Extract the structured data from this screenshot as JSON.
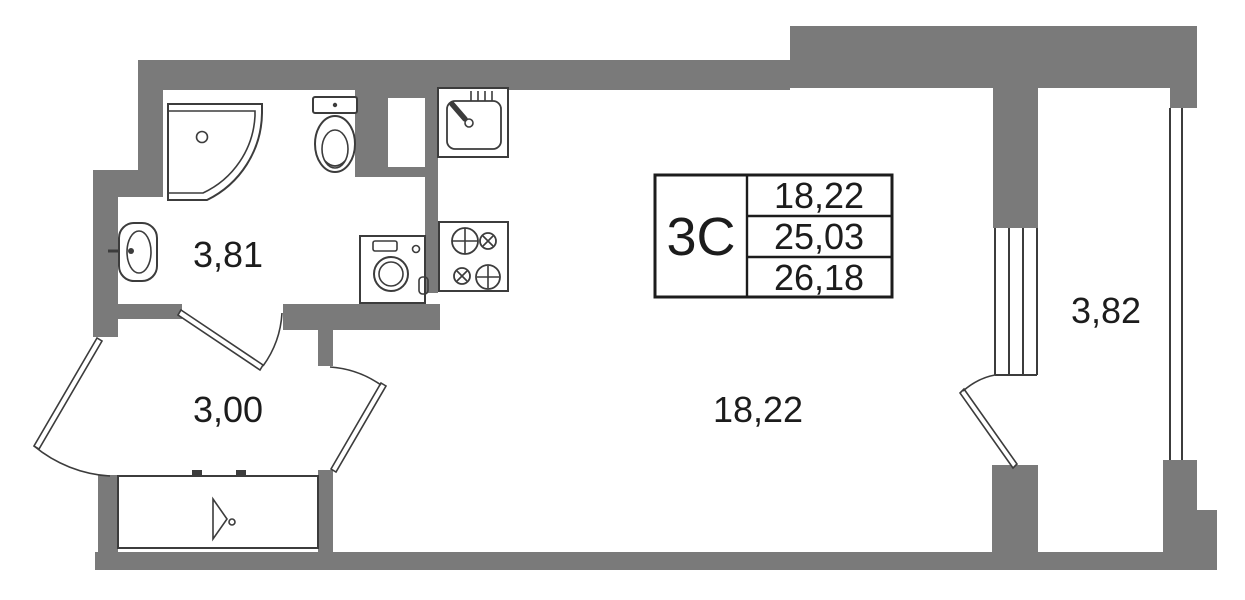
{
  "plan": {
    "rooms": [
      {
        "id": "bathroom",
        "area": "3,81"
      },
      {
        "id": "hallway",
        "area": "3,00"
      },
      {
        "id": "living-room",
        "area": "18,22"
      },
      {
        "id": "balcony",
        "area": "3,82"
      }
    ],
    "info_box": {
      "unit_type": "3С",
      "rows": [
        "18,22",
        "25,03",
        "26,18"
      ]
    },
    "icons": [
      "shower-icon",
      "toilet-icon",
      "washbasin-icon",
      "washing-machine-icon",
      "kitchen-sink-icon",
      "stove-icon",
      "entrance-door-icon",
      "door-swing-icon",
      "window-icon"
    ],
    "colors": {
      "wall": "#7a7a7a",
      "line": "#3c3c3c",
      "text": "#1c1c1c",
      "background": "#ffffff"
    }
  }
}
